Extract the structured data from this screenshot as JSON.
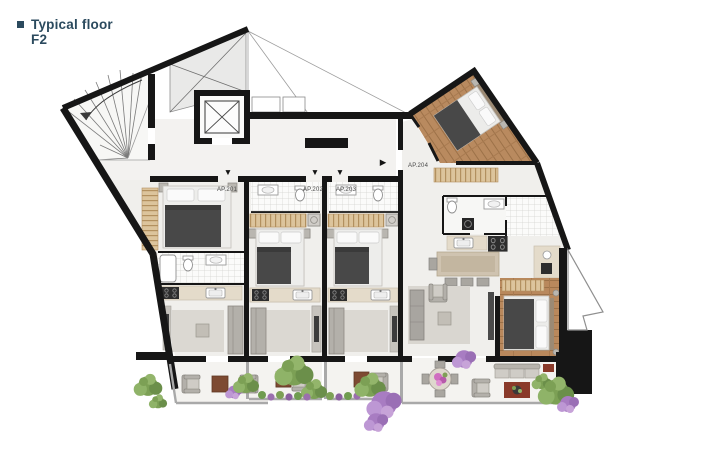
{
  "title": {
    "line1": "Typical floor",
    "line2": "F2"
  },
  "title_color": "#2b4a5e",
  "units": [
    {
      "label": "AP.201"
    },
    {
      "label": "AP.202"
    },
    {
      "label": "AP.203"
    },
    {
      "label": "AP.204"
    }
  ],
  "door_arrows": {
    "down": "▼",
    "right": "▶"
  },
  "icons": {
    "bullet": "square-bullet",
    "door_arrow_down": "▼",
    "door_arrow_right": "▶"
  },
  "colors": {
    "wall": "#161616",
    "floor": "#f0efec",
    "balcony_floor": "#f4f3f0",
    "wood": "#b9885c",
    "blanket": "#484848",
    "cabinet_tan": "#dcc49c",
    "sofa_gray": "#b3b0aa",
    "rug_gray": "#dbd8d2",
    "rug_red": "#8a3a2a",
    "plant_green": "#7ca055",
    "plant_purple": "#a87cc2",
    "label_gray": "#4a4a4a"
  }
}
